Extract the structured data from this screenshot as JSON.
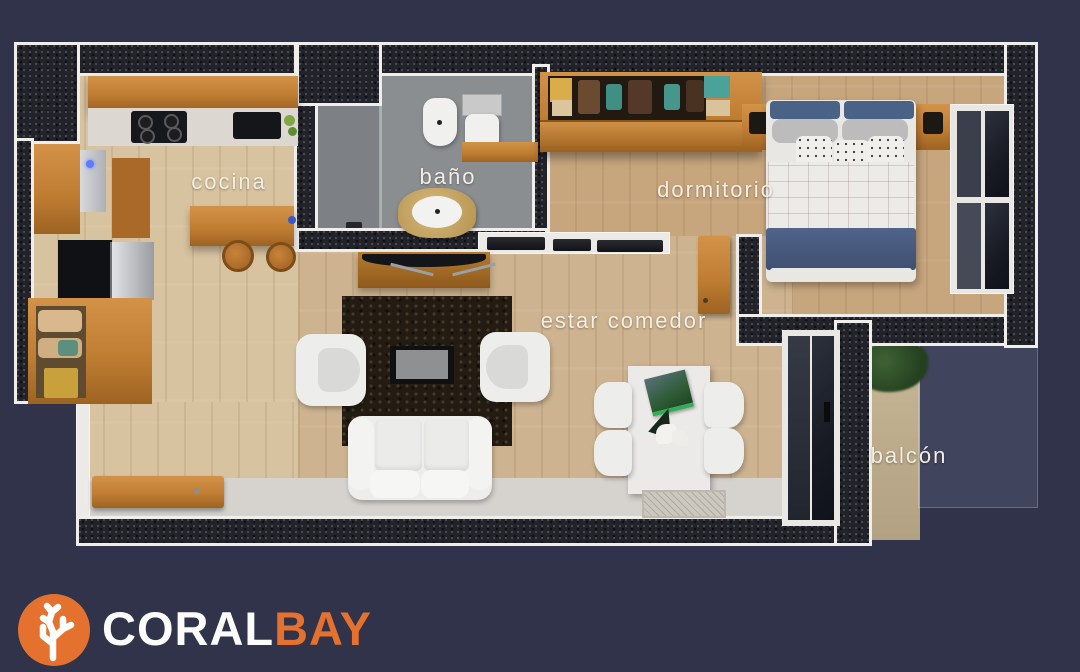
{
  "colors": {
    "background": "#30334a",
    "wall_core": "#222229",
    "wall_edge": "#efeeea",
    "accent_orange": "#e4722e",
    "wood": "#c07e33",
    "bed_navy": "#485a7d"
  },
  "floorplan": {
    "type": "apartment-3d-top-view-floor-plan",
    "rooms": [
      {
        "id": "cocina",
        "label": "cocina"
      },
      {
        "id": "bano",
        "label": "baño"
      },
      {
        "id": "dormitorio",
        "label": "dormitorio"
      },
      {
        "id": "estar-comedor",
        "label": "estar comedor"
      },
      {
        "id": "balcon",
        "label": "balcón"
      }
    ]
  },
  "logo": {
    "icon": "coral-icon",
    "icon_bg_color": "#e4722e",
    "text_primary": "CORAL",
    "text_secondary": "BAY",
    "text_primary_color": "#fbfbfa",
    "text_secondary_color": "#e4722e"
  }
}
